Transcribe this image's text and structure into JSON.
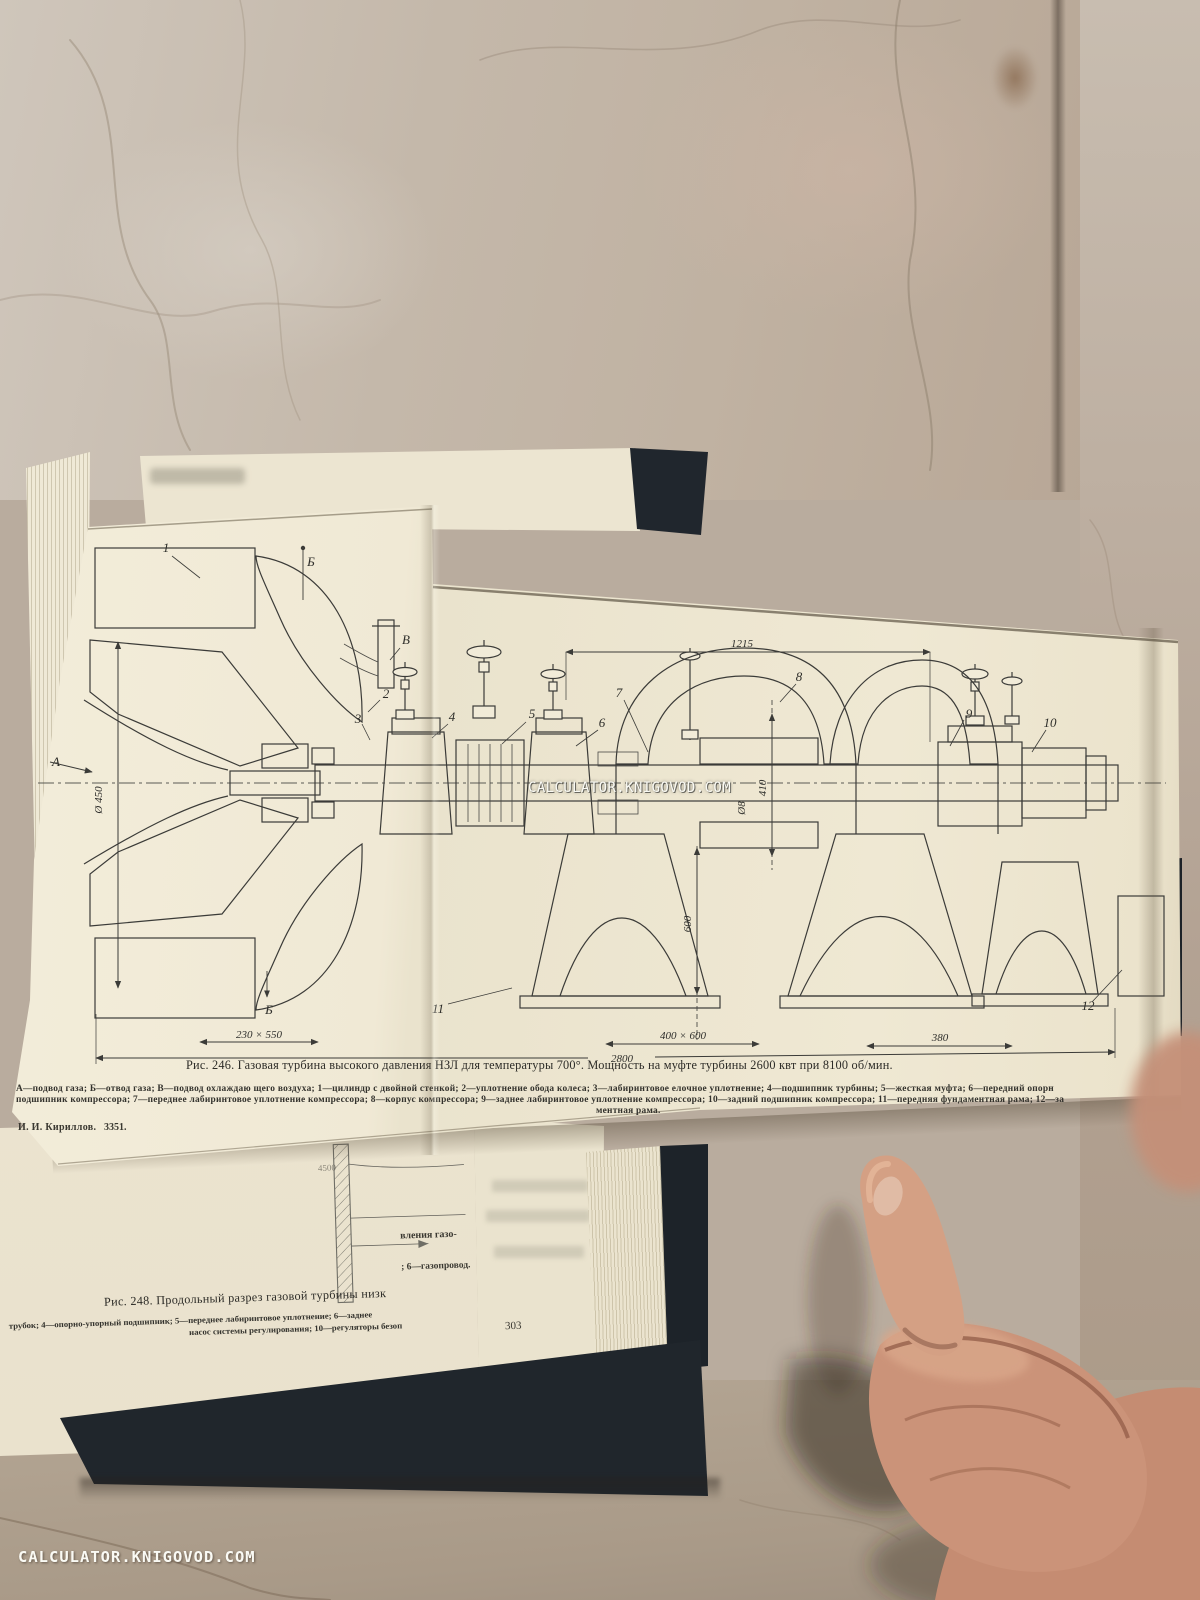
{
  "watermarks": {
    "center": "CALCULATOR.KNIGOVOD.COM",
    "bottom_left": "CALCULATOR.KNIGOVOD.COM"
  },
  "foldout": {
    "caption": "Рис. 246. Газовая турбина высокого давления НЗЛ для температуры 700°. Мощность на муфте турбины 2600 квт при 8100 об/мин.",
    "legend_line_1": "А—подвод газа; Б—отвод газа; В—подвод охлаждаю щего воздуха; 1—цилиндр с двойной стенкой; 2—уплотнение обода колеса; 3—лабиринтовое елочное уплотнение; 4—подшипник турбины; 5—жесткая муфта; 6—передний опорн",
    "legend_line_2": "подшипник компрессора; 7—переднее лабиринтовое уплотнение компрессора; 8—корпус компрессора; 9—заднее лабиринтовое уплотнение компрессора; 10—задний подшипник компрессора; 11—передняя фундаментная рама; 12—за",
    "legend_line_3": "ментная рама.",
    "author": "И. И. Кириллов.",
    "print_code": "3351."
  },
  "diagram": {
    "dims": {
      "top_span": "1215",
      "inlet_diameter": "Ø 450",
      "rotor_span": "410",
      "shaft_diameter": "Ø8",
      "exhaust_height": "600",
      "inlet_flange": "230 × 550",
      "overall_length": "2800",
      "exhaust_flange": "400 × 600",
      "rear_span": "380"
    },
    "parts": [
      "А",
      "Б",
      "В",
      "1",
      "2",
      "3",
      "4",
      "5",
      "6",
      "7",
      "8",
      "9",
      "10",
      "11",
      "12",
      "Б"
    ]
  },
  "lower_page": {
    "fragment_dim": "4500",
    "fragment_1": "вления газо-",
    "fragment_2": "; 6—газопровод.",
    "caption_248": "Рис. 248. Продольный разрез газовой турбины низк",
    "legend_line_1": "трубок; 4—опорно-упорный подшипник; 5—переднее лабиринтовое уплотнение; 6—заднее",
    "legend_line_2": "насос системы регулирования; 10—регуляторы безоп",
    "page_number": "303"
  }
}
